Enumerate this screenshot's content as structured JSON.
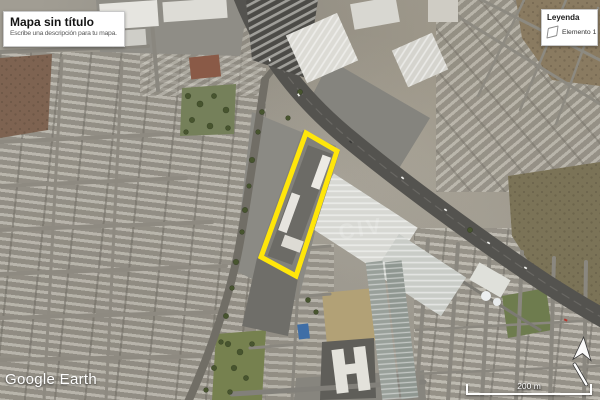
{
  "map_card": {
    "title": "Mapa sin título",
    "subtitle": "Escribe una descripción para tu mapa."
  },
  "legend": {
    "title": "Leyenda",
    "items": [
      {
        "icon": "polygon-icon",
        "label": "Elemento 1"
      }
    ]
  },
  "scale_bar": {
    "label": "200 m"
  },
  "attribution": {
    "brand": "Google Earth"
  },
  "map": {
    "type": "satellite-imagery",
    "overlay_polygon": {
      "name": "Elemento 1",
      "color": "#ffe60a",
      "points": "306,133 337,151 296,276 261,257"
    },
    "imagery_watermark": "CIV"
  },
  "colors": {
    "polygon_accent": "#ffe60a",
    "card_bg": "#ffffff",
    "highway": "#54534f"
  }
}
